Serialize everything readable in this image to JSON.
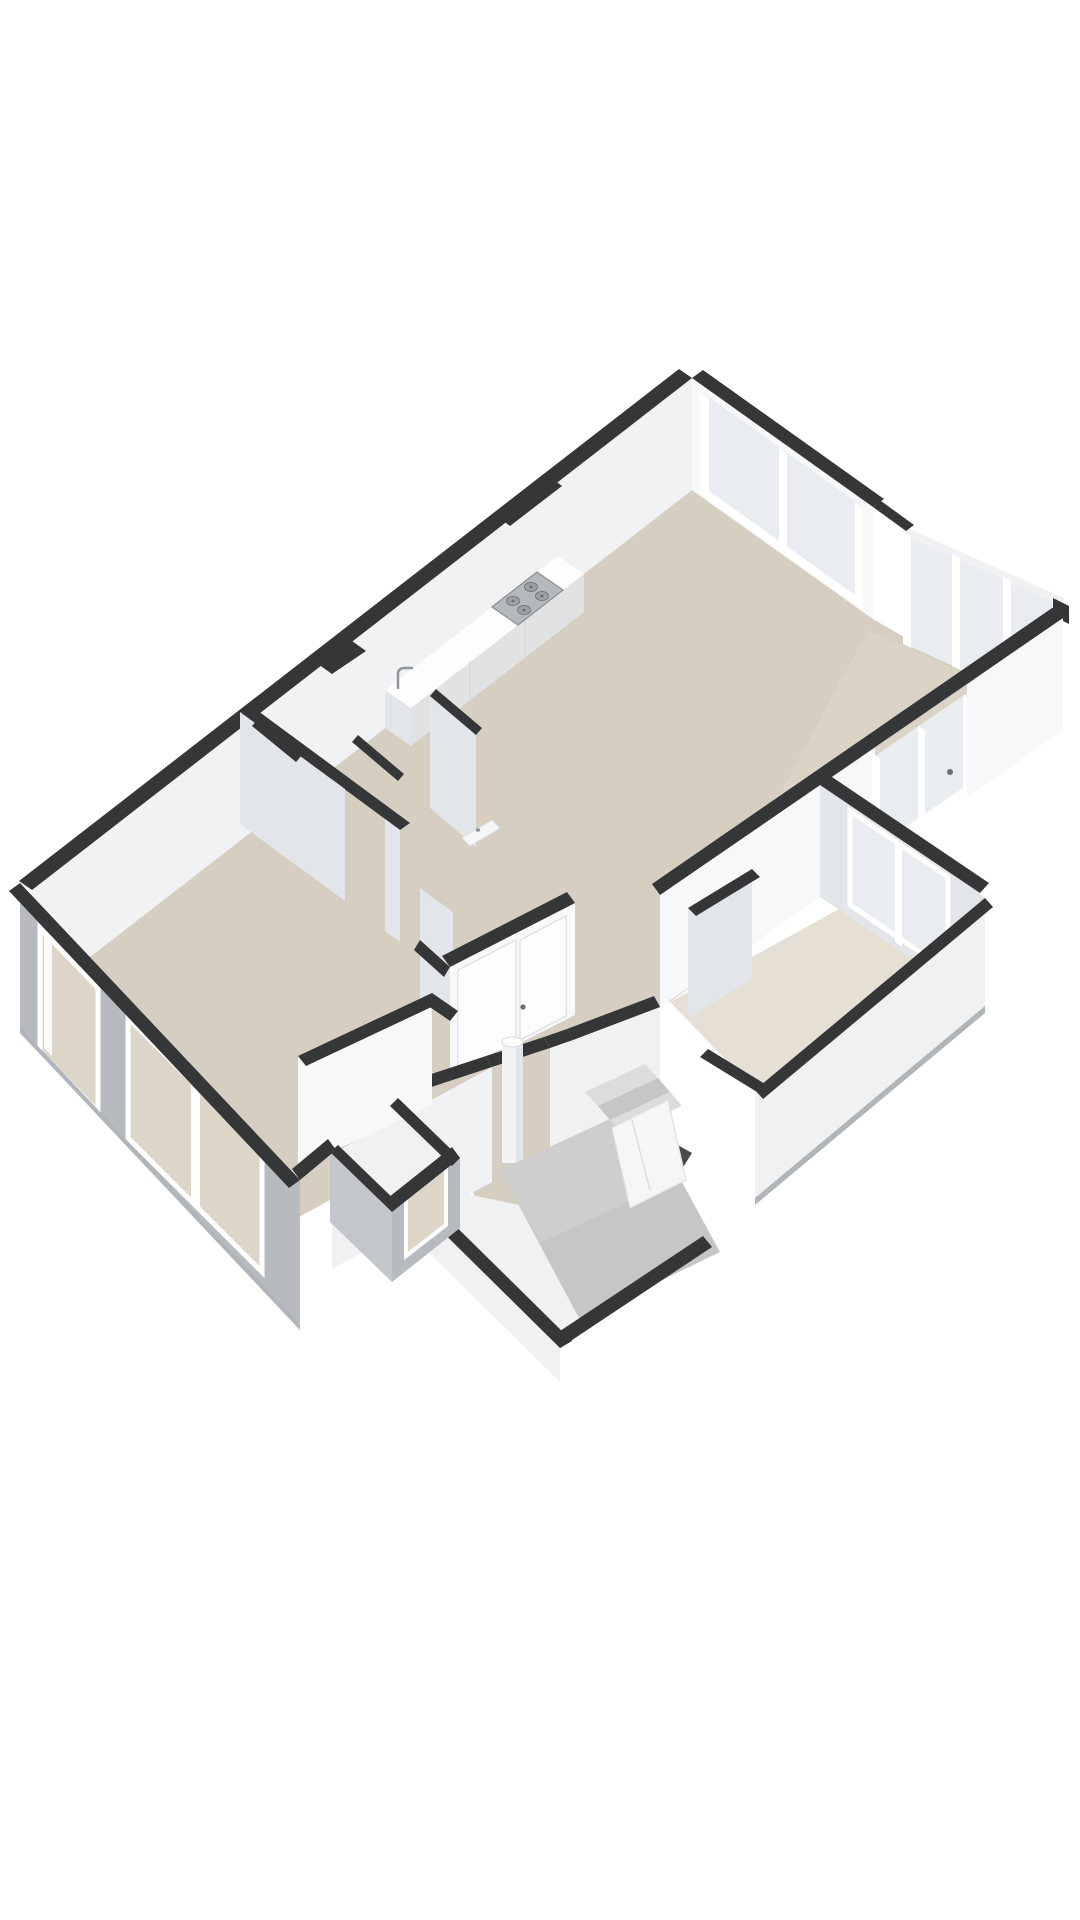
{
  "scene": {
    "type": "3d-isometric-floorplan-render",
    "background": "#ffffff",
    "palette": {
      "wallCap": "#343638",
      "wallCapSoft": "#47494b",
      "wallInner": "#f0f2f4",
      "wallInnerBright": "#f7f8f9",
      "wallInnerShaded": "#e2e5e9",
      "wallOuter": "#b7bbbf",
      "wallOuterShade": "#c3c7cb",
      "wallOuterLight": "#eff1f3",
      "plinth": "#b0b5b9",
      "floor": "#d6cec0",
      "floorPale": "#e6e0d4",
      "floorBalcony": "#dbd3c5",
      "glass": "#e9edf1",
      "glassDim": "#dde3e8",
      "windowThrough": "#ddd6c8",
      "frame": "#ffffff",
      "frameShade": "#d8dcdf",
      "stair": "#c6c6c7",
      "stairLight": "#d2d2d2",
      "stairStep": "#dcdcdc",
      "stove": "#b5b9bd",
      "stoveEdge": "#8a8e92",
      "burner": "#9aa0a4",
      "burnerDark": "#6b6f73",
      "metal": "#8f959a",
      "doorLeaf": "#fdfdfe",
      "doorSeam": "#d5d9dc",
      "handle": "#6b6f73",
      "fixture": "#f4f6f7",
      "fixtureEdge": "#dde1e4"
    },
    "features": [
      "living-room",
      "balcony",
      "glass-sliding-doors",
      "balcony-glazing",
      "kitchen",
      "kitchen-counter",
      "gas-hob",
      "kitchen-faucet",
      "bathroom",
      "toilet",
      "double-doors",
      "washbasin",
      "hallway",
      "column",
      "bedroom",
      "closet",
      "staircase-ramp",
      "winder-steps",
      "meter-cupboard",
      "window",
      "window",
      "window",
      "window",
      "window",
      "stairwell-annex",
      "side-annex-room"
    ]
  }
}
